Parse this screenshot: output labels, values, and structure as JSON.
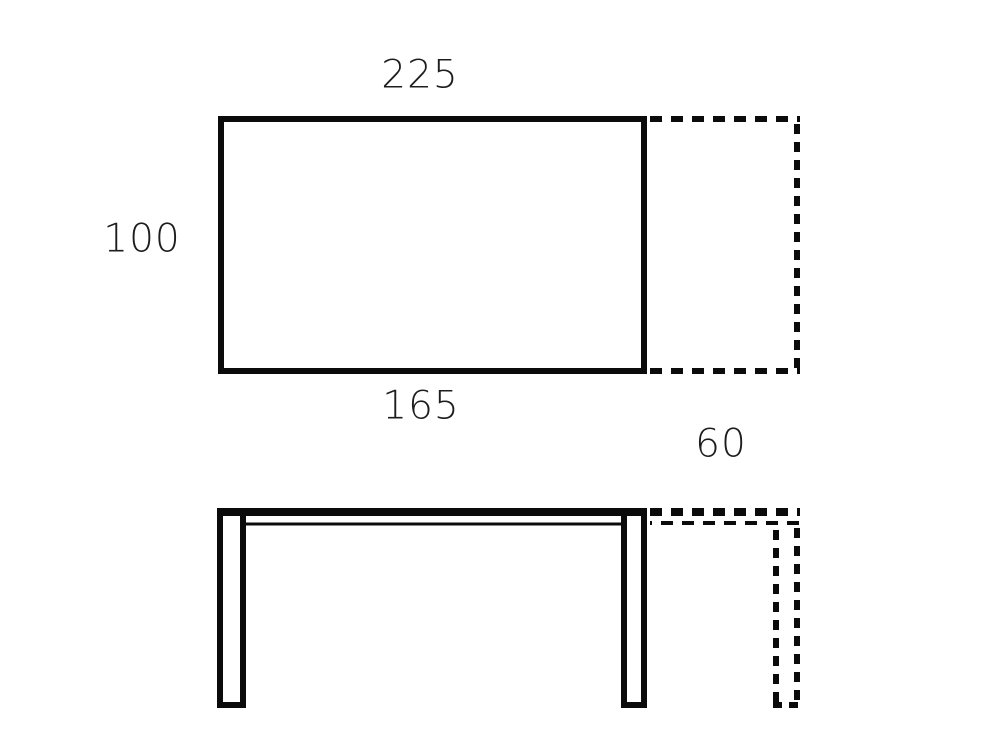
{
  "dimensions": {
    "extended_width": "225",
    "depth": "100",
    "closed_width": "165",
    "extension": "60"
  },
  "views": {
    "top_view": "table-top-view-with-dashed-extension-leaf",
    "front_view": "table-front-view-with-dashed-extension-leaf"
  },
  "colors": {
    "line": "#0b0b0b",
    "text": "#1d1d1d",
    "background": "#ffffff"
  }
}
